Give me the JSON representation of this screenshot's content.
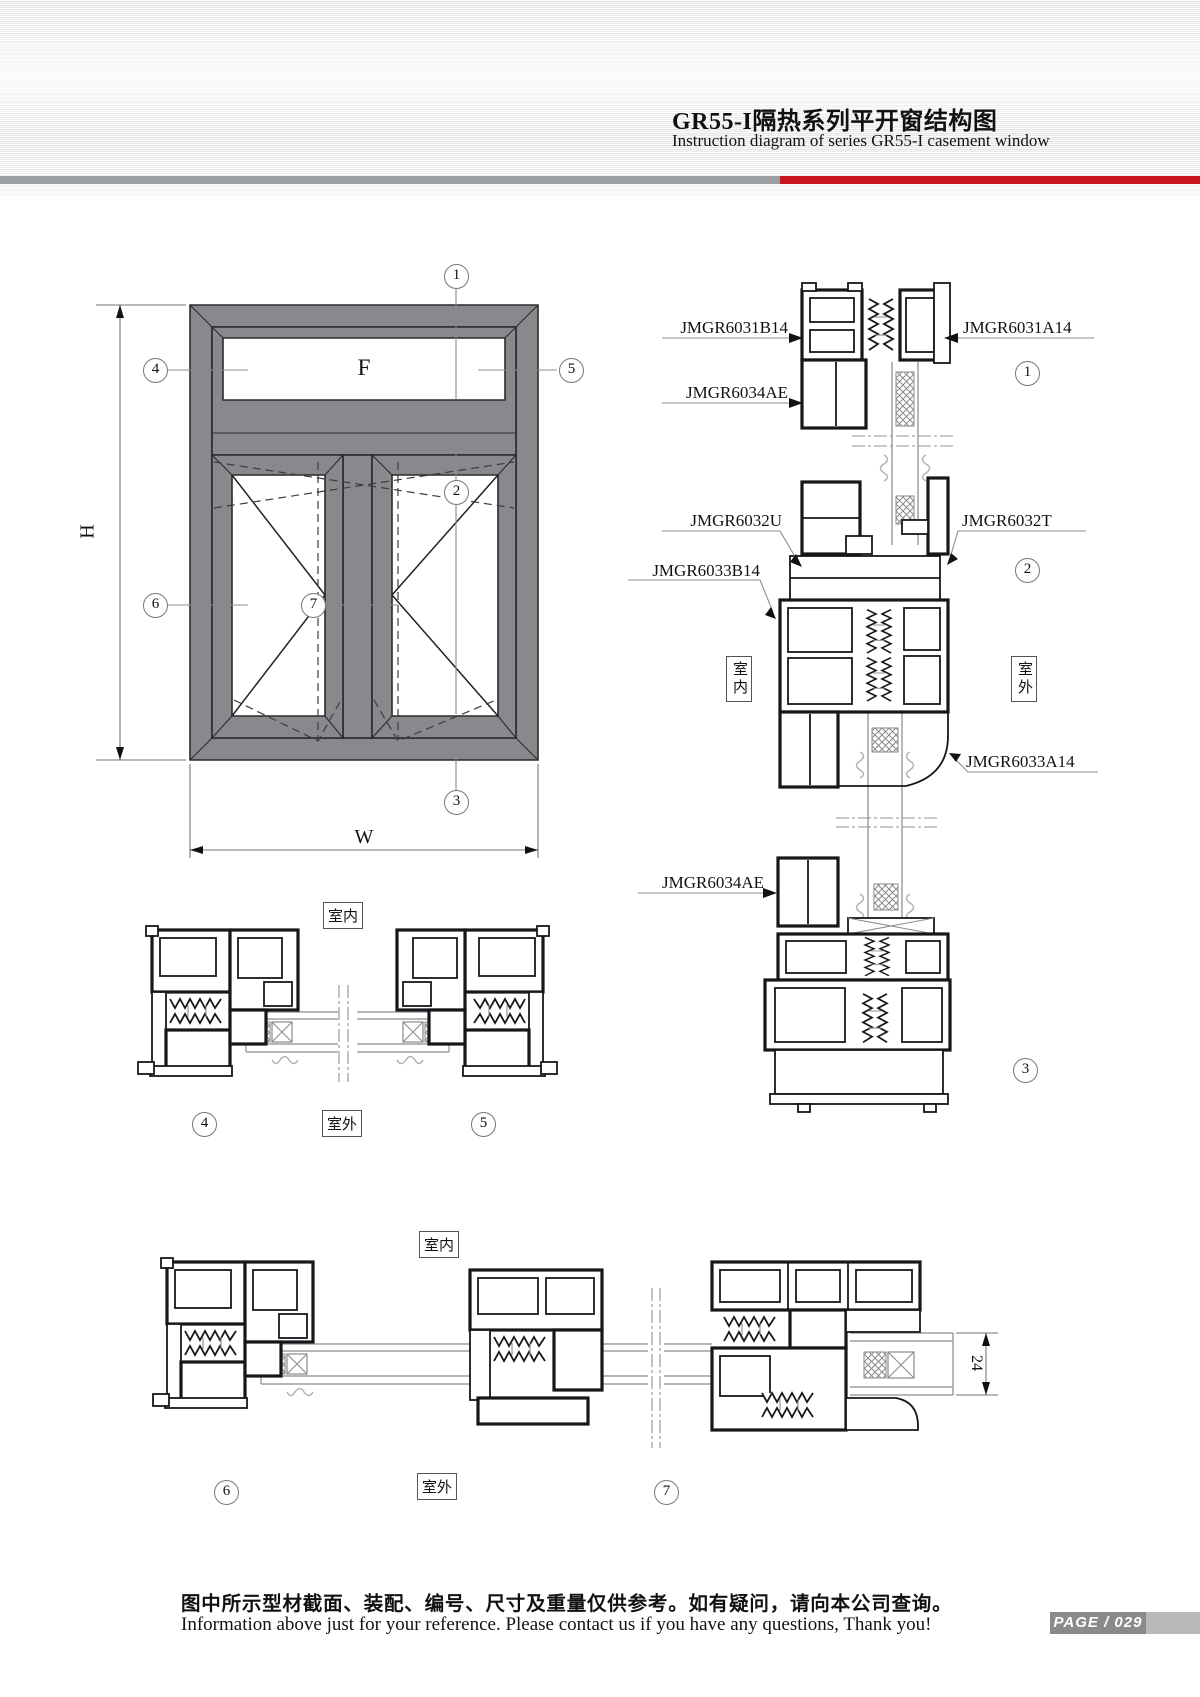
{
  "header": {
    "title": "GR55-I隔热系列平开窗结构图",
    "subtitle": "Instruction diagram of series GR55-I casement window"
  },
  "colors": {
    "accent_red": "#c8161e",
    "frame_gray": "#87898d",
    "bar_gray": "#9b9ea3"
  },
  "elevation": {
    "dim_height": "H",
    "dim_width": "W",
    "fixed_pane": "F",
    "callout_1": "1",
    "callout_2": "2",
    "callout_3": "3",
    "callout_4": "4",
    "callout_5": "5",
    "callout_6": "6",
    "callout_7": "7"
  },
  "right_sections": {
    "label_6031b14": "JMGR6031B14",
    "label_6031a14": "JMGR6031A14",
    "label_6034ae_top": "JMGR6034AE",
    "label_6032u": "JMGR6032U",
    "label_6032t": "JMGR6032T",
    "label_6033b14": "JMGR6033B14",
    "label_6033a14": "JMGR6033A14",
    "label_6034ae_bottom": "JMGR6034AE",
    "callout_1": "1",
    "callout_2": "2",
    "callout_3": "3",
    "indoor": "室内",
    "outdoor": "室外"
  },
  "middle_section": {
    "indoor": "室内",
    "outdoor": "室外",
    "callout_4": "4",
    "callout_5": "5"
  },
  "bottom_section": {
    "indoor": "室内",
    "outdoor": "室外",
    "callout_6": "6",
    "callout_7": "7",
    "glass_dim": "24"
  },
  "footer": {
    "note_cn": "图中所示型材截面、装配、编号、尺寸及重量仅供参考。如有疑问，请向本公司查询。",
    "note_en": "Information above just for your reference. Please contact us if you have any questions, Thank you!",
    "page_label": "PAGE / 029"
  }
}
